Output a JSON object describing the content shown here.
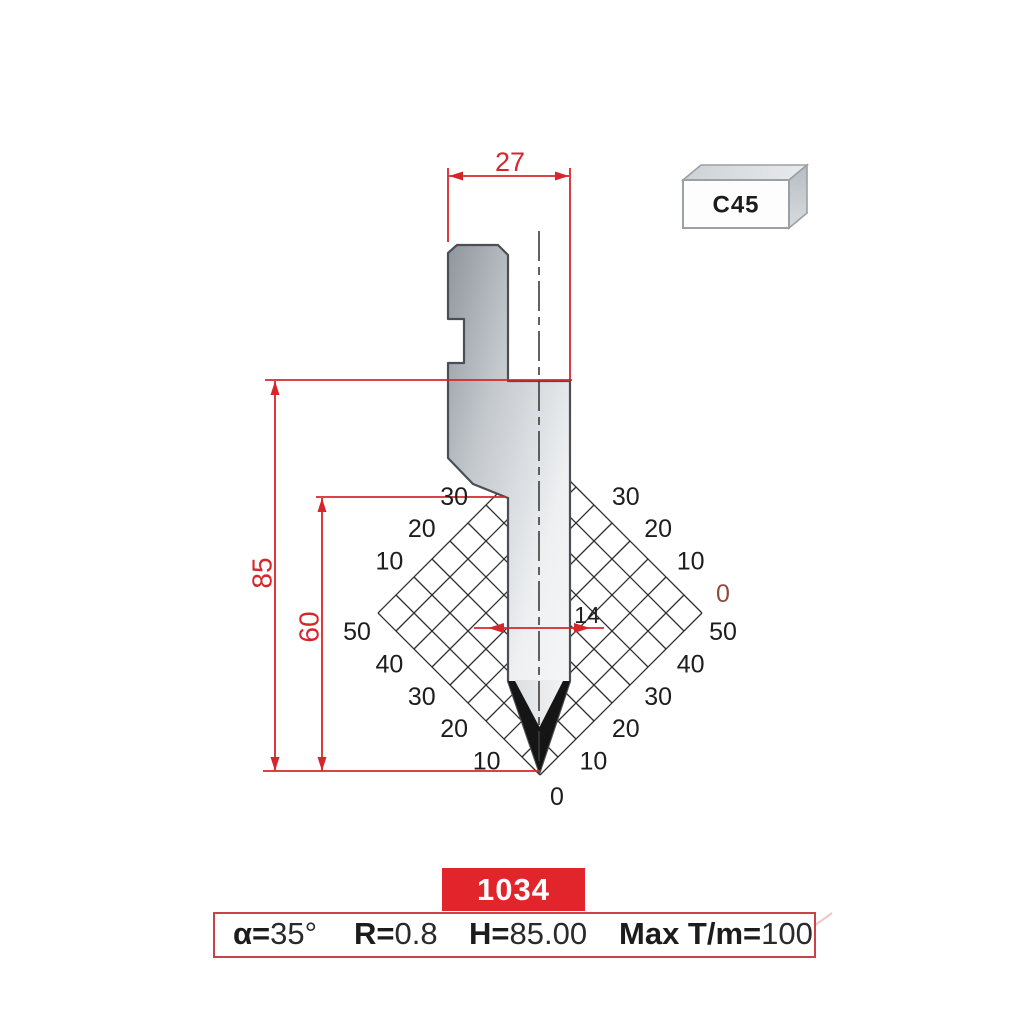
{
  "material": {
    "label": "C45"
  },
  "part_number": "1034",
  "specs": [
    {
      "label": "α=",
      "value": "35°"
    },
    {
      "label": "R=",
      "value": "0.8"
    },
    {
      "label": "H=",
      "value": "85.00"
    },
    {
      "label": "Max T/m=",
      "value": "100"
    }
  ],
  "dims": {
    "top_width": "27",
    "total_height": "85",
    "working_height": "60",
    "tip_width": "14"
  },
  "grid_labels": {
    "upper_left": [
      "10",
      "20",
      "30"
    ],
    "lower_left": [
      "10",
      "20",
      "30",
      "40",
      "50"
    ],
    "lower_right": [
      "10",
      "20",
      "30",
      "40",
      "50"
    ],
    "upper_right": [
      "0",
      "10",
      "20",
      "30"
    ],
    "origin": "0"
  },
  "colors": {
    "dimension_red": "#d6262b",
    "part_box_red": "#e2242b",
    "spec_border_red": "#cb4147",
    "zero_brown": "#8f4a3c",
    "grid_line": "#2e2e2e",
    "label_black": "#1d1d1d",
    "outline_gray": "#4b4f54"
  }
}
